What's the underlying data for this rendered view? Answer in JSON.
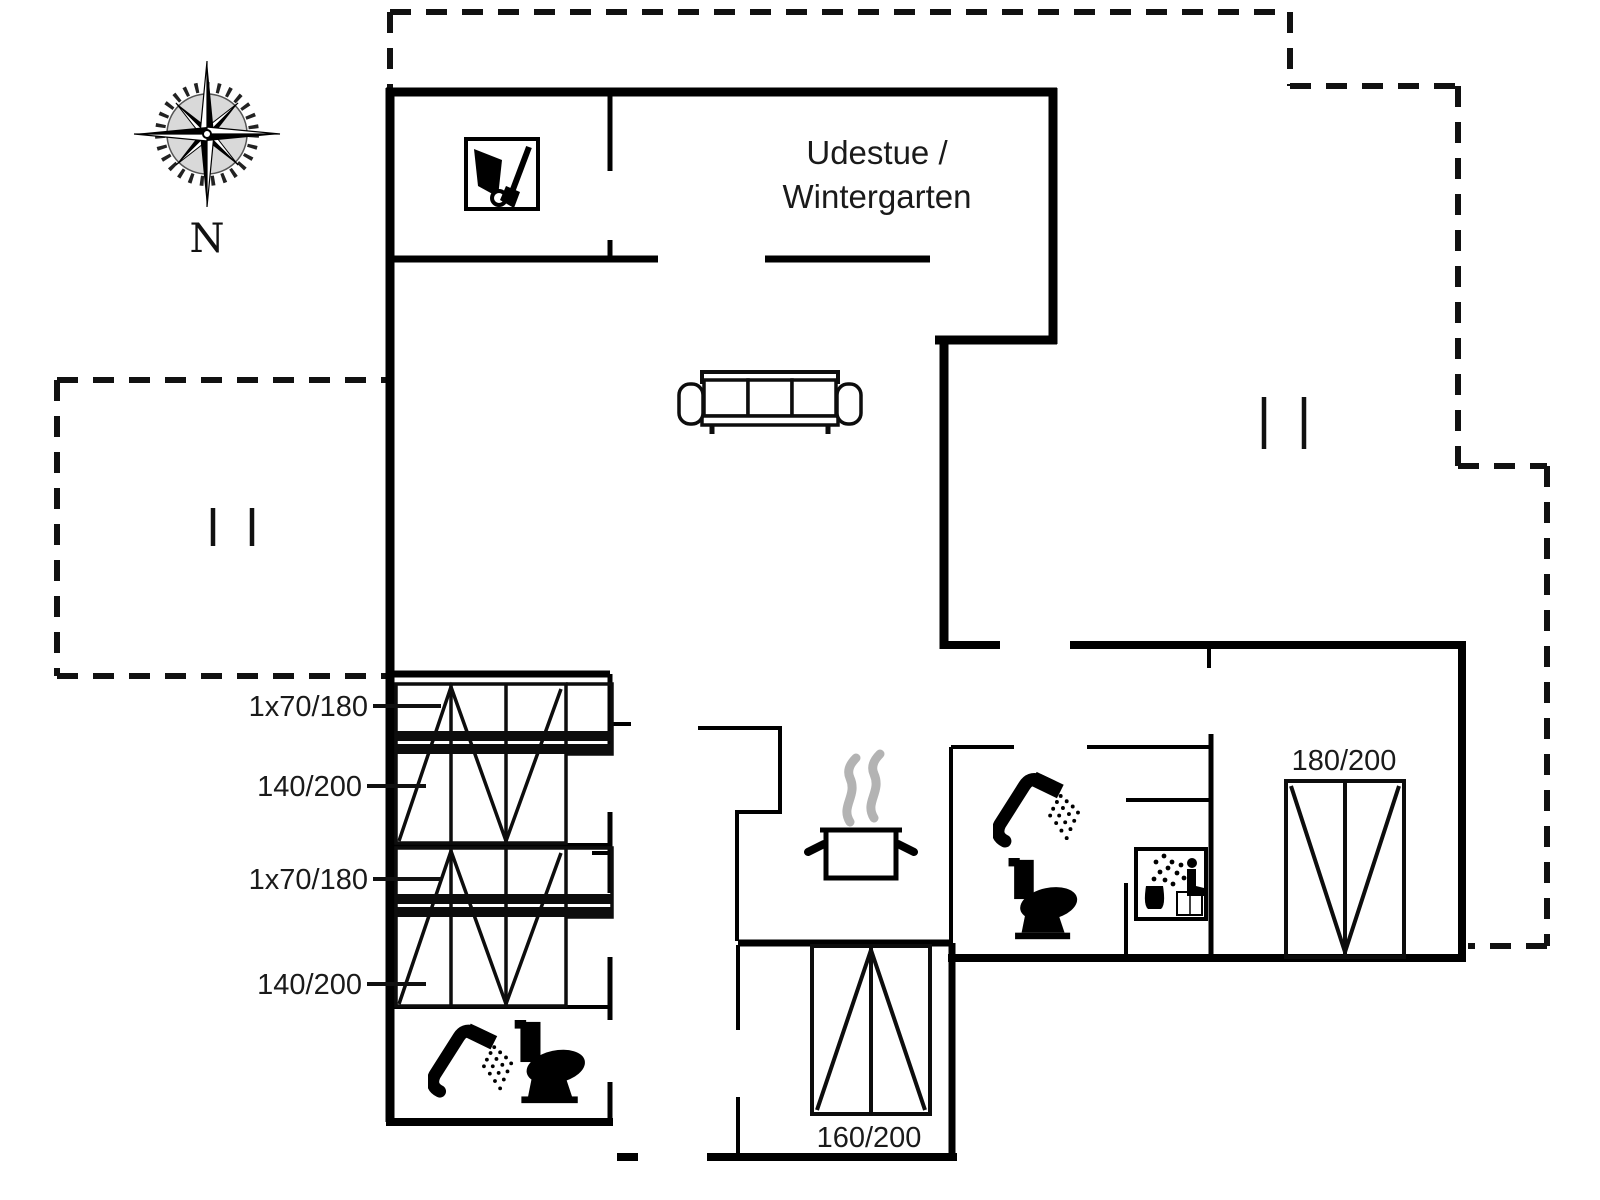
{
  "plan": {
    "room_label": {
      "line1": "Udestue /",
      "line2": "Wintergarten"
    },
    "compass_label": "N",
    "beds": {
      "bunk_top_label_1": "1x70/180",
      "bunk_bottom_label_1": "140/200",
      "bunk_top_label_2": "1x70/180",
      "bunk_bottom_label_2": "140/200",
      "double_bed_small": "160/200",
      "double_bed_large": "180/200"
    },
    "icons": [
      "compass-rose-icon",
      "wheelbarrow-icon",
      "sofa-icon",
      "cooking-pot-icon",
      "steam-icon",
      "shower-icon",
      "toilet-icon",
      "sauna-icon",
      "bunk-bed-symbol",
      "double-bed-symbol"
    ],
    "colors": {
      "wall": "#000000",
      "line": "#0d0d0d",
      "steam": "#b3b3b3",
      "text": "#1a1a1a",
      "compass_disc": "#d9d9d9",
      "background": "#ffffff"
    }
  }
}
